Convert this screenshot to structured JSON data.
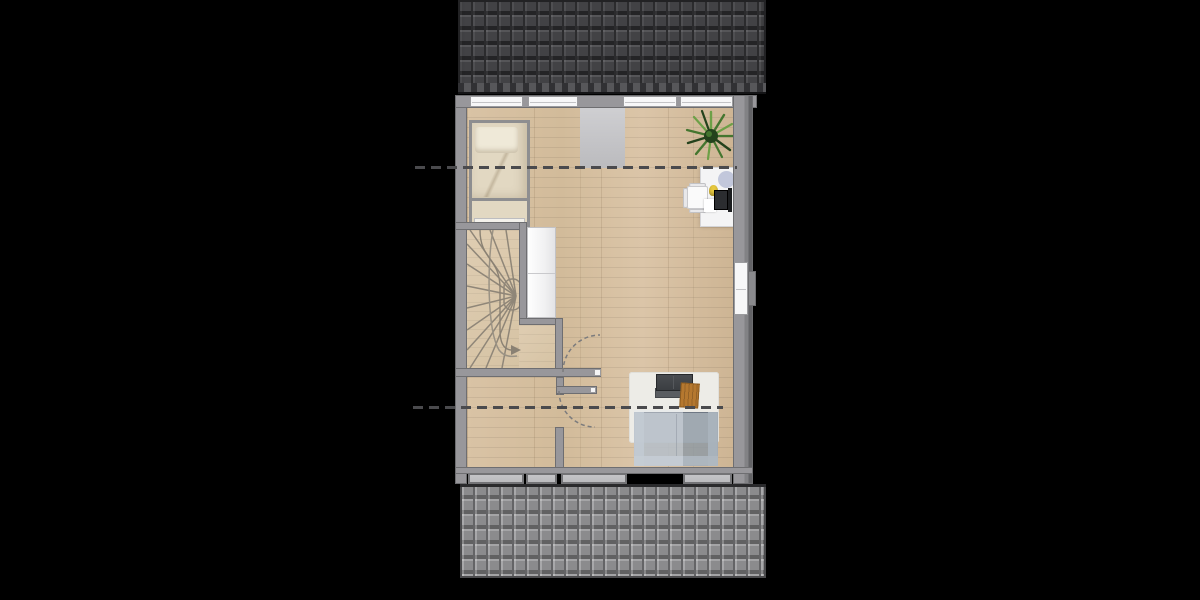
{
  "scene": {
    "kind": "architectural floor plan, top-down 2D view of an attic / upper storey",
    "background_note": "plan centered on black canvas, pitched roof shown above and below the room"
  },
  "colors": {
    "background": "#000000",
    "roof_dark_base": "#424245",
    "roof_dark_gap": "#2b2b2d",
    "roof_light_base": "#8b8b8d",
    "roof_light_gap": "#646466",
    "wall": "#98979b",
    "wall_edge": "#6e6e71",
    "wall_dark": "#636366",
    "window_white": "#f7f7f8",
    "sill": "#b9b9bc",
    "strip": "#c6c6c9",
    "bed_frame": "#8e8e90",
    "bedding": "#e2d8c2",
    "pillow": "#efe9d8",
    "bench_white": "#f4f2ec",
    "cabinet": "#f1f1f2",
    "tread": "#8f8678",
    "dash": "#4a4a4d",
    "arc": "#7b7b7d",
    "rug": "#edece7",
    "sofa_dark": "#3a3d41",
    "sofa_dark2": "#5a5d61",
    "table_orange": "#b5782f",
    "sofa_blue": "#8c98a4",
    "desk": "#f4f4f5",
    "chair": "#fafafa",
    "laptop": "#2b2d30",
    "lamp": "#e8c93e",
    "mat": "#b9bed6",
    "paper": "#ffffff",
    "plant_dark": "#24421c",
    "plant_mid": "#44762f",
    "plant_light": "#6da047"
  },
  "elements": {
    "roofs": [
      "dark tiled roof at top",
      "light grey tiled roof at bottom"
    ],
    "openings": [
      "four roof windows in top wall",
      "four sill boxes in bottom wall",
      "window in right wall",
      "two interior door swings with dashed arcs"
    ],
    "furniture": [
      "single bed with pillow",
      "foot bench",
      "white wardrobe beside stairs",
      "winder staircase with direction arrow",
      "white desk",
      "office chair",
      "laptop and screen",
      "desk lamp",
      "papers",
      "round floor mat",
      "potted plant",
      "white area rug",
      "dark lounge seat with grey footstool",
      "orange wooden side table",
      "translucent blue two-seat sofa"
    ],
    "annotations": [
      "upper dashed section line",
      "lower dashed section line",
      "light grey landing strip below top wall"
    ]
  }
}
